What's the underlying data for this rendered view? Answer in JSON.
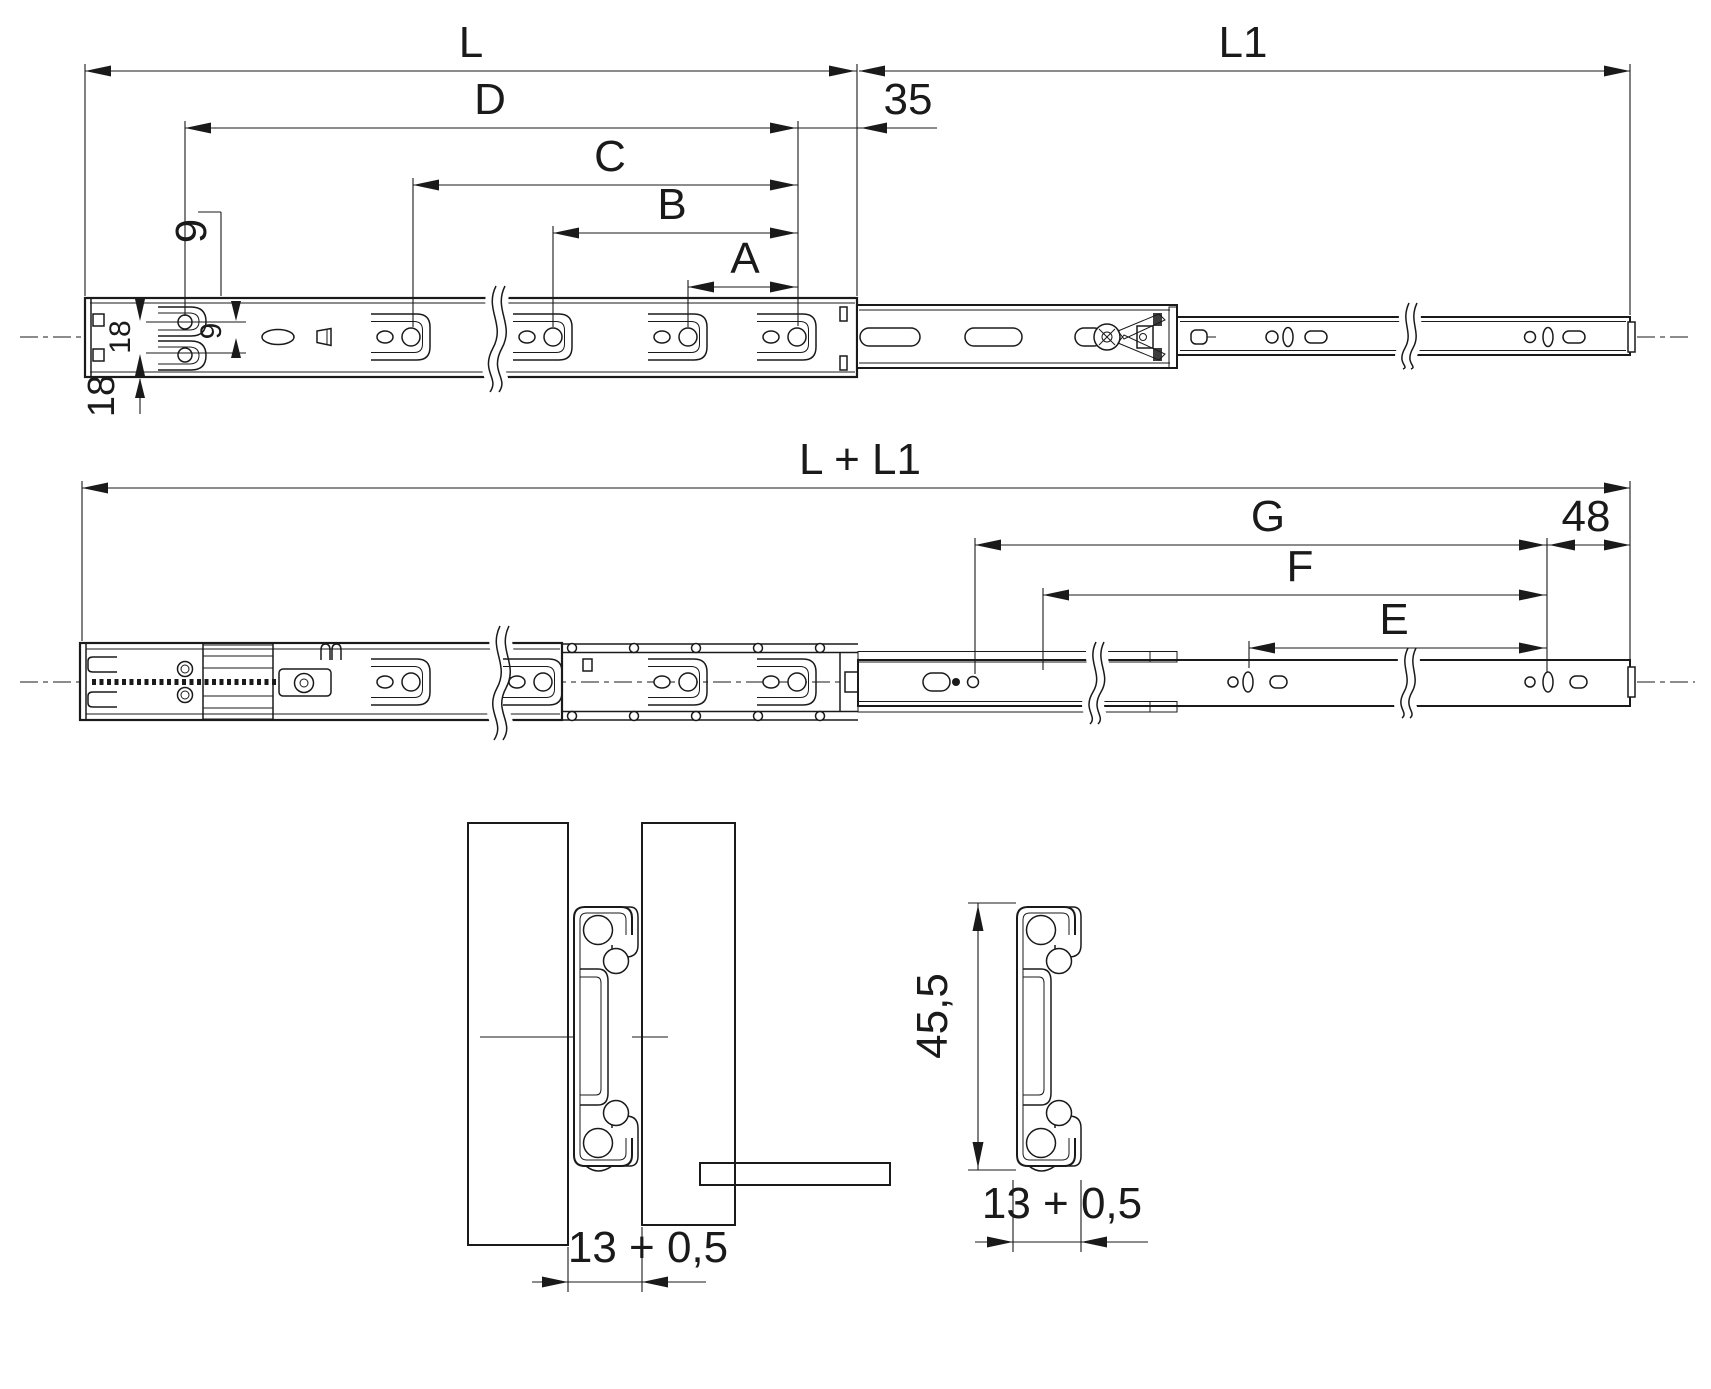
{
  "colors": {
    "wood": "#F7C469",
    "line": "#1a1a1a",
    "background": "#ffffff"
  },
  "drawing": {
    "closed_view": {
      "length_label": "L",
      "extension_label": "L1",
      "d_label": "D",
      "c_label": "C",
      "b_label": "B",
      "a_label": "A",
      "end_offset": "35",
      "hole_offset_top": "9",
      "hole_offset_inner": "9",
      "hole_row_spacing": "18",
      "rear_spacing": "18"
    },
    "extended_view": {
      "total_label": "L + L1",
      "g_label": "G",
      "f_label": "F",
      "e_label": "E",
      "end_offset": "48"
    },
    "mounting_view": {
      "gap_label": "13 + 0,5"
    },
    "profile_view": {
      "height_label": "45,5",
      "width_label": "13 + 0,5"
    }
  }
}
